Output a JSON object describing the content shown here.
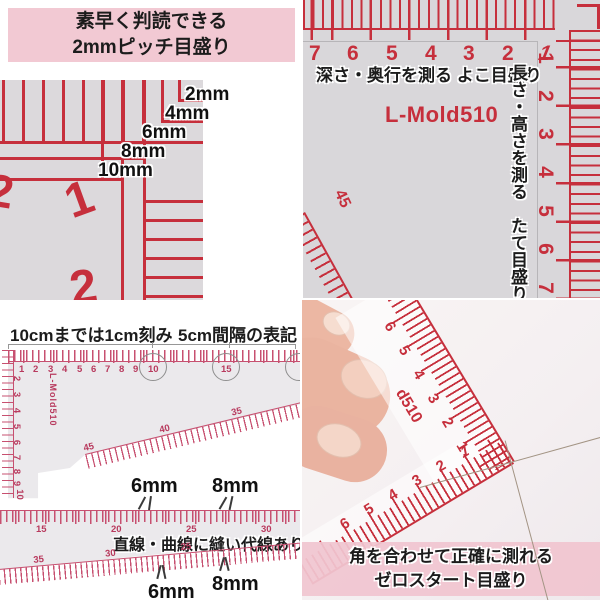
{
  "colors": {
    "banner_pink": "#f2c9d3",
    "photo_ruler_red": "#c62f3c",
    "scan_ruler_red": "#c75070",
    "photo_gray": "#dcd9dc",
    "text_black": "#1c1c1c"
  },
  "top_left": {
    "banner_line1": "素早く判読できる",
    "banner_line2": "2mmピッチ目盛り",
    "step_labels": [
      "2mm",
      "4mm",
      "6mm",
      "8mm",
      "10mm"
    ],
    "ruler_numbers": [
      "2",
      "1",
      "2"
    ]
  },
  "top_right": {
    "caption_horizontal": "深さ・奥行を測る よこ目盛り",
    "caption_vertical": "長さ・高さを測る　たて目盛り",
    "product": "L-Mold510",
    "top_scale": [
      "7",
      "6",
      "5",
      "4",
      "3",
      "2",
      "1"
    ],
    "right_scale": [
      "1",
      "2",
      "3",
      "4",
      "5",
      "6",
      "7"
    ],
    "diagonal_label": "45"
  },
  "bottom_left": {
    "heading_left": "10cmまでは1cm刻み",
    "heading_right": "5cm間隔の表記",
    "top_scale": [
      "1",
      "2",
      "3",
      "4",
      "5",
      "6",
      "7",
      "8",
      "9",
      "10",
      "15"
    ],
    "circled_values": [
      "10",
      "15"
    ],
    "left_scale": [
      "2",
      "3",
      "4",
      "5",
      "6",
      "7",
      "8",
      "9",
      "10"
    ],
    "product": "L-Mold510",
    "diagonal_labels": [
      "45",
      "40",
      "35"
    ],
    "strip_scale": [
      "15",
      "20",
      "25",
      "30"
    ],
    "caption": "直線・曲線に縫い代線あり",
    "curve_labels": [
      "35",
      "30",
      "25"
    ],
    "seam_top_6": "6mm",
    "seam_top_8": "8mm",
    "seam_bottom_6": "6mm",
    "seam_bottom_8": "8mm"
  },
  "bottom_right": {
    "banner_line1": "角を合わせて正確に測れる",
    "banner_line2": "ゼロスタート目盛り",
    "edge_up_scale": [
      "1",
      "2",
      "3",
      "4",
      "5",
      "6"
    ],
    "edge_left_scale": [
      "1",
      "2",
      "3",
      "4",
      "5",
      "6"
    ],
    "product_partial": "d510"
  }
}
